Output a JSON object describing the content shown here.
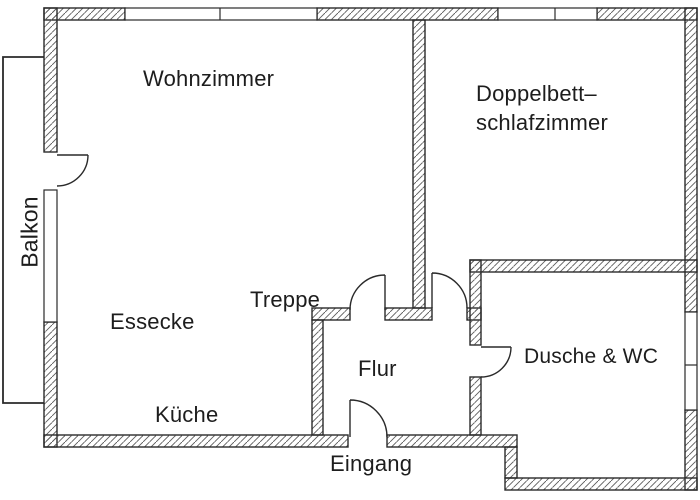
{
  "plan": {
    "kind": "apartment-floor-plan"
  },
  "rooms": {
    "wohnzimmer": {
      "label": "Wohnzimmer"
    },
    "schlafzimmer": {
      "line1": "Doppelbett–",
      "line2": "schlafzimmer"
    },
    "balkon": {
      "label": "Balkon"
    },
    "essecke": {
      "label": "Essecke"
    },
    "treppe": {
      "label": "Treppe"
    },
    "kueche": {
      "label": "Küche"
    },
    "flur": {
      "label": "Flur"
    },
    "eingang": {
      "label": "Eingang"
    },
    "dusche_wc": {
      "label": "Dusche & WC"
    }
  },
  "colors": {
    "wall_line": "#2a2a2a",
    "hatch_line": "#5a5a5a",
    "text": "#1d1d1d",
    "background": "#ffffff"
  }
}
